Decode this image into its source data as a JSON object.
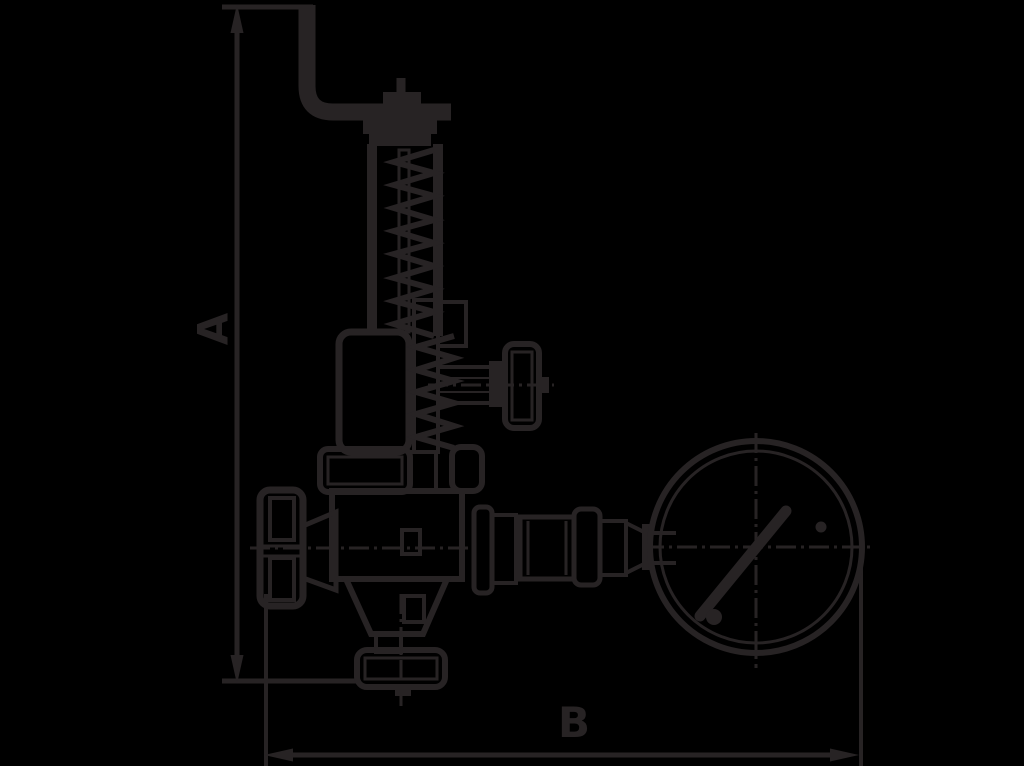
{
  "drawing": {
    "background_color": "#000000",
    "ink_color": "#272324",
    "canvas": {
      "width": 1024,
      "height": 766
    },
    "dimensions": {
      "height_label": "A",
      "width_label": "B"
    }
  }
}
